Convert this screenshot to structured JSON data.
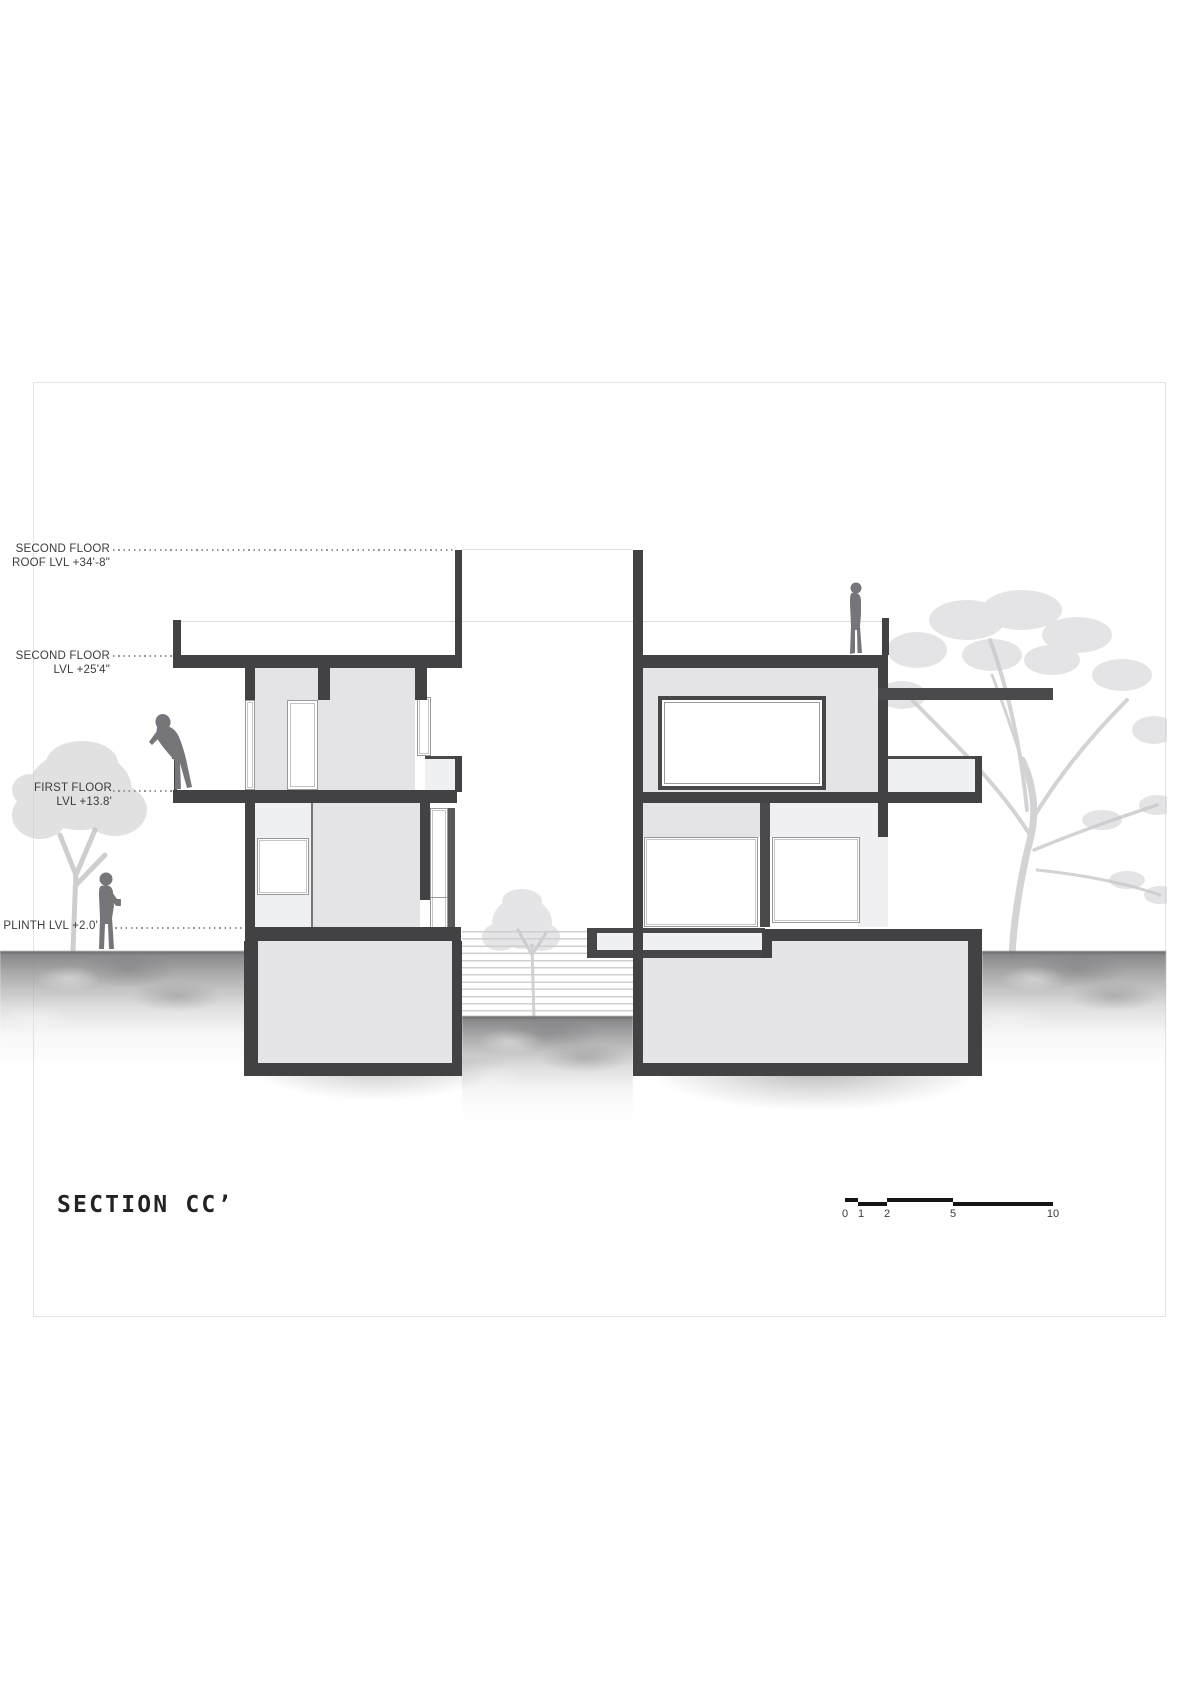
{
  "title": "SECTION CC’",
  "levels": [
    {
      "line1": "SECOND FLOOR",
      "line2": "ROOF LVL +34'-8\""
    },
    {
      "line1": "SECOND FLOOR",
      "line2": "LVL +25'4\""
    },
    {
      "line1": "FIRST FLOOR",
      "line2": "LVL +13.8'"
    },
    {
      "line1": "PLINTH LVL +2.0'",
      "line2": ""
    }
  ],
  "scale": {
    "labels": [
      "0",
      "1",
      "2",
      "5",
      "10"
    ]
  },
  "figures": [
    "person-leaning-on-terrace",
    "person-standing-at-plinth",
    "person-standing-on-roof"
  ],
  "vegetation": [
    "tree-left",
    "tree-courtyard",
    "tree-right"
  ],
  "colors": {
    "cut_structure": "#424245",
    "wall_elevation": "#e4e4e6",
    "light_panel": "#eef0f2",
    "basement_fill": "#e5e5e7",
    "ground": "#8d8d8d",
    "tree": "#cbcbce",
    "figure": "#76767a",
    "dotted_line": "#949494"
  }
}
